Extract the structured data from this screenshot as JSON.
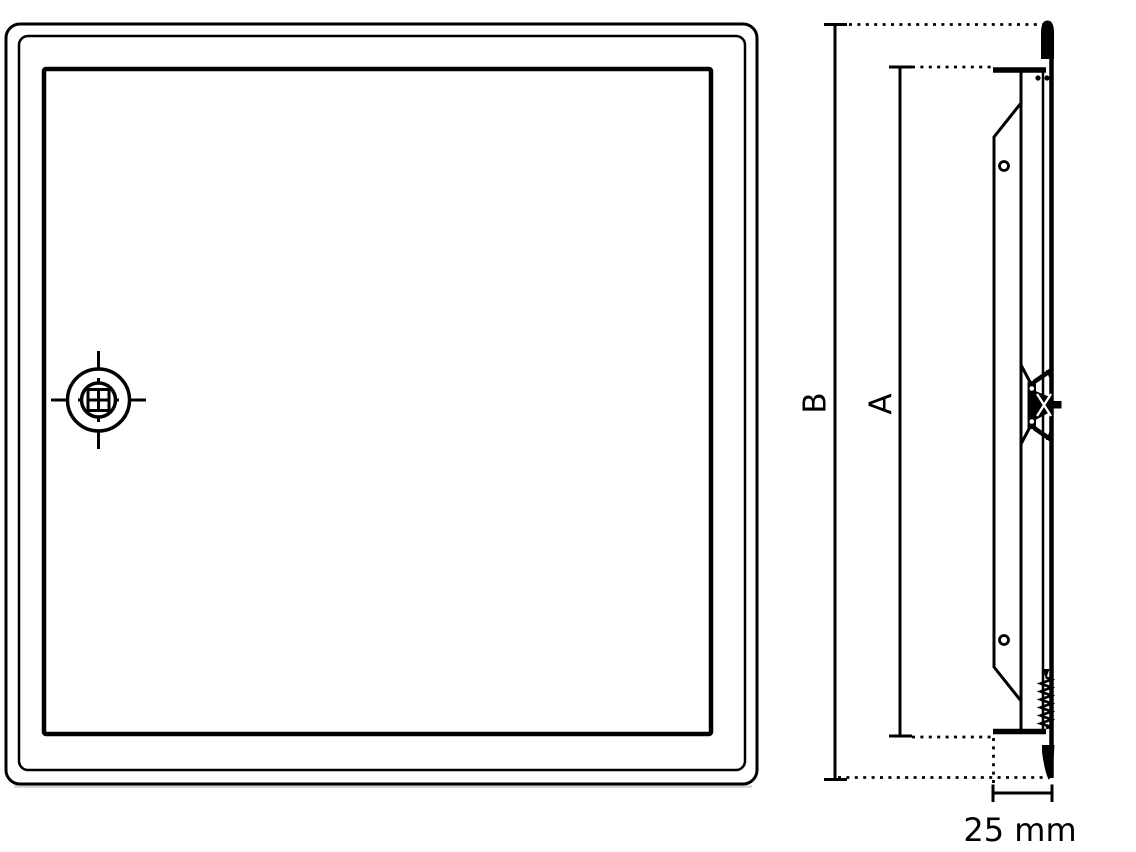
{
  "diagram": {
    "kind": "access-panel-technical-drawing",
    "colors": {
      "background": "#ffffff",
      "line": "#000000",
      "shadow": "#aaaaaa"
    },
    "labels": {
      "dim_height_outer": "B",
      "dim_height_inner": "A",
      "dim_depth": "25 mm"
    }
  }
}
